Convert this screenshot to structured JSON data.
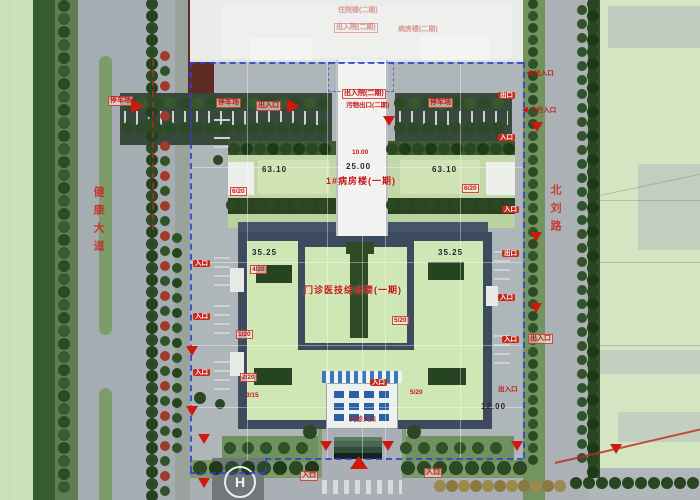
{
  "helipad": {
    "letter": "H"
  },
  "streets": {
    "west": "健康大道",
    "east": "北刘路"
  },
  "buildings": {
    "main_complex": "门诊医技综合楼(一期)",
    "ward_phase1": "1#病房楼(一期)",
    "inpatient_phase2": "住院楼(二期)",
    "ward_phase2": "病房楼(二期)"
  },
  "dimensions": [
    "63.10",
    "25.00",
    "63.10",
    "35.25",
    "35.25",
    "12.00",
    "10.00"
  ],
  "colors": {
    "boundary_blue": "#2f3fd0",
    "annotation_red": "#c41510",
    "roof_green": "#cfe7b4",
    "road_gray": "#a9afb4",
    "tree_green": "#2c4a26"
  },
  "annotations": [
    {
      "x": 92,
      "y": 186,
      "t": "健康大道",
      "k": "street-v",
      "n": "street-name-west"
    },
    {
      "x": 549,
      "y": 184,
      "t": "北刘路",
      "k": "street-v",
      "n": "street-name-east"
    },
    {
      "x": 338,
      "y": 7,
      "t": "住院楼(二期)",
      "k": "red-faded",
      "n": "label-inpatient-phase2"
    },
    {
      "x": 334,
      "y": 23,
      "t": "出入院(二期)",
      "k": "red-faded-box",
      "n": "label-entry-phase2-faded"
    },
    {
      "x": 398,
      "y": 26,
      "t": "病房楼(二期)",
      "k": "red-faded",
      "n": "label-ward-phase2"
    },
    {
      "x": 108,
      "y": 96,
      "t": "停车场",
      "k": "red-box",
      "n": "label-parking-west"
    },
    {
      "x": 131,
      "y": 99,
      "k": "arrow-right",
      "n": "entrance-arrow"
    },
    {
      "x": 216,
      "y": 98,
      "t": "停车场",
      "k": "red-box",
      "n": "label-parking-left"
    },
    {
      "x": 256,
      "y": 101,
      "t": "出入口",
      "k": "red-box",
      "n": "label-gateway"
    },
    {
      "x": 287,
      "y": 99,
      "k": "arrow-right",
      "n": "entrance-arrow"
    },
    {
      "x": 428,
      "y": 98,
      "t": "停车场",
      "k": "red-box",
      "n": "label-parking-right"
    },
    {
      "x": 342,
      "y": 89,
      "t": "出入院(二期)",
      "k": "red-box",
      "n": "label-entry-phase2"
    },
    {
      "x": 346,
      "y": 102,
      "t": "污物出口(二期)",
      "k": "red-small",
      "n": "label-waste-exit"
    },
    {
      "x": 383,
      "y": 116,
      "k": "arrow-down",
      "n": "entrance-arrow"
    },
    {
      "x": 526,
      "y": 70,
      "t": "◀ 出入口",
      "k": "red-left",
      "n": "label-east-gate"
    },
    {
      "x": 522,
      "y": 107,
      "t": "◀ 人行入口",
      "k": "red-left",
      "n": "label-pedestrian-entry"
    },
    {
      "x": 531,
      "y": 122,
      "k": "arrow-down",
      "n": "entrance-arrow"
    },
    {
      "x": 262,
      "y": 166,
      "t": "63.10",
      "k": "dim",
      "n": "dim-ward-left"
    },
    {
      "x": 346,
      "y": 163,
      "t": "25.00",
      "k": "dim",
      "n": "dim-ward-mid"
    },
    {
      "x": 432,
      "y": 166,
      "t": "63.10",
      "k": "dim",
      "n": "dim-ward-right"
    },
    {
      "x": 352,
      "y": 149,
      "t": "10.00",
      "k": "red-small",
      "n": "dim-red-small"
    },
    {
      "x": 326,
      "y": 177,
      "t": "1#病房楼(一期)",
      "k": "red-big",
      "n": "label-ward-phase1"
    },
    {
      "x": 230,
      "y": 187,
      "t": "6/20",
      "k": "red-small-box",
      "n": "code-badge"
    },
    {
      "x": 462,
      "y": 184,
      "t": "6/20",
      "k": "red-small-box",
      "n": "code-badge"
    },
    {
      "x": 252,
      "y": 249,
      "t": "35.25",
      "k": "dim",
      "n": "dim-main-left"
    },
    {
      "x": 438,
      "y": 249,
      "t": "35.25",
      "k": "dim",
      "n": "dim-main-right"
    },
    {
      "x": 304,
      "y": 286,
      "t": "门诊医技综合楼(一期)",
      "k": "red-big",
      "n": "label-main-complex"
    },
    {
      "x": 392,
      "y": 316,
      "t": "5/20",
      "k": "red-small-box",
      "n": "code-badge"
    },
    {
      "x": 250,
      "y": 265,
      "t": "4/20",
      "k": "red-small-box",
      "n": "code-badge"
    },
    {
      "x": 236,
      "y": 330,
      "t": "1/20",
      "k": "red-small-box",
      "n": "code-badge"
    },
    {
      "x": 240,
      "y": 373,
      "t": "2/20",
      "k": "red-small-box",
      "n": "code-badge"
    },
    {
      "x": 246,
      "y": 392,
      "t": "3/15",
      "k": "red-small",
      "n": "code-badge"
    },
    {
      "x": 410,
      "y": 389,
      "t": "5/20",
      "k": "red-small",
      "n": "code-badge"
    },
    {
      "x": 481,
      "y": 403,
      "t": "12.00",
      "k": "dim",
      "n": "dim-main-bottom"
    },
    {
      "x": 370,
      "y": 379,
      "t": "入口",
      "k": "red-badge",
      "n": "label-canopy-entry"
    },
    {
      "x": 350,
      "y": 416,
      "t": "门诊入口",
      "k": "red-small",
      "n": "label-outpatient-entry"
    },
    {
      "x": 193,
      "y": 260,
      "t": "入口",
      "k": "red-badge",
      "n": "label-west-entry"
    },
    {
      "x": 193,
      "y": 313,
      "t": "入口",
      "k": "red-badge",
      "n": "label-west-entry"
    },
    {
      "x": 193,
      "y": 369,
      "t": "入口",
      "k": "red-badge",
      "n": "label-west-entry"
    },
    {
      "x": 498,
      "y": 92,
      "t": "出口",
      "k": "red-badge",
      "n": "label-east-exit"
    },
    {
      "x": 498,
      "y": 134,
      "t": "入口",
      "k": "red-badge",
      "n": "label-east-entry"
    },
    {
      "x": 502,
      "y": 206,
      "t": "入口",
      "k": "red-badge",
      "n": "label-east-entry"
    },
    {
      "x": 502,
      "y": 250,
      "t": "出口",
      "k": "red-badge",
      "n": "label-east-exit"
    },
    {
      "x": 498,
      "y": 294,
      "t": "入口",
      "k": "red-badge",
      "n": "label-east-entry"
    },
    {
      "x": 502,
      "y": 336,
      "t": "入口",
      "k": "red-badge",
      "n": "label-east-entry"
    },
    {
      "x": 498,
      "y": 386,
      "t": "出入口",
      "k": "red-small",
      "n": "label-east-gateway"
    },
    {
      "x": 530,
      "y": 232,
      "k": "arrow-down",
      "n": "entrance-arrow"
    },
    {
      "x": 530,
      "y": 303,
      "k": "arrow-down",
      "n": "entrance-arrow"
    },
    {
      "x": 528,
      "y": 334,
      "t": "出入口",
      "k": "red-box",
      "n": "label-east-gateway"
    },
    {
      "x": 198,
      "y": 434,
      "k": "arrow-down",
      "n": "boundary-arrow"
    },
    {
      "x": 320,
      "y": 441,
      "k": "arrow-down",
      "n": "boundary-arrow"
    },
    {
      "x": 382,
      "y": 441,
      "k": "arrow-down",
      "n": "boundary-arrow"
    },
    {
      "x": 511,
      "y": 441,
      "k": "arrow-down",
      "n": "boundary-arrow"
    },
    {
      "x": 350,
      "y": 456,
      "k": "arrow-up",
      "n": "main-gate-arrow"
    },
    {
      "x": 198,
      "y": 478,
      "k": "arrow-down",
      "n": "boundary-arrow"
    },
    {
      "x": 610,
      "y": 444,
      "k": "arrow-down",
      "n": "boundary-arrow"
    },
    {
      "x": 300,
      "y": 471,
      "t": "入口",
      "k": "red-box",
      "n": "label-south-entry"
    },
    {
      "x": 424,
      "y": 468,
      "t": "入口",
      "k": "red-box",
      "n": "label-south-entry"
    },
    {
      "x": 186,
      "y": 346,
      "k": "arrow-down",
      "n": "boundary-arrow"
    },
    {
      "x": 186,
      "y": 406,
      "k": "arrow-down",
      "n": "boundary-arrow"
    },
    {
      "x": 555,
      "y": 462,
      "k": "red-line",
      "w": 150,
      "rot": -13,
      "n": "red-route-line"
    }
  ]
}
